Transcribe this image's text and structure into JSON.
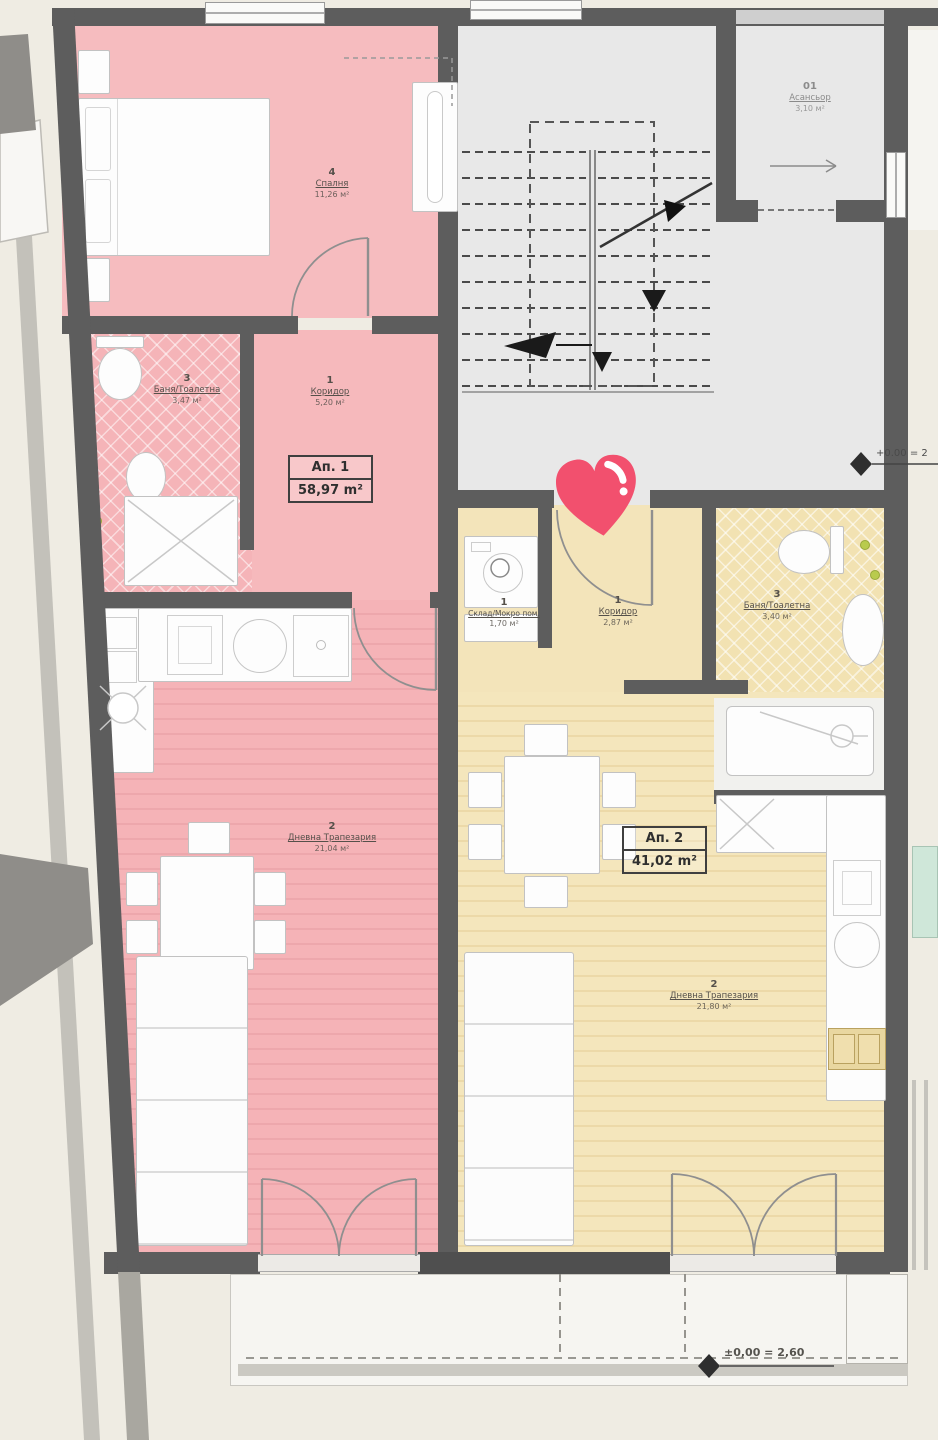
{
  "apartment1": {
    "badge": {
      "title": "Ап. 1",
      "area": "58,97 m²"
    },
    "rooms": {
      "bedroom": {
        "num": "4",
        "name": "Спалня",
        "area": "11,26 м²"
      },
      "bath": {
        "num": "3",
        "name": "Баня/Тоалетна",
        "area": "3,47 м²"
      },
      "corridor": {
        "num": "1",
        "name": "Коридор",
        "area": "5,20 м²"
      },
      "living": {
        "num": "2",
        "name": "Дневна Трапезария",
        "area": "21,04 м²"
      }
    }
  },
  "apartment2": {
    "badge": {
      "title": "Ап. 2",
      "area": "41,02 m²"
    },
    "rooms": {
      "storage": {
        "num": "1",
        "name": "Склад/Мокро пом.",
        "area": "1,70 м²"
      },
      "corridor": {
        "num": "1",
        "name": "Коридор",
        "area": "2,87 м²"
      },
      "bath": {
        "num": "3",
        "name": "Баня/Тоалетна",
        "area": "3,40 м²"
      },
      "living": {
        "num": "2",
        "name": "Дневна Трапезария",
        "area": "21,80 м²"
      }
    }
  },
  "common": {
    "elevator": {
      "num": "01",
      "name": "Асансьор",
      "area": "3,10 м²"
    },
    "elevation_right": "+0.00 = 2",
    "elevation_bottom": "±0,00 = 2,60"
  },
  "colors": {
    "apartment1_fill": "#f5b6ba",
    "apartment2_fill": "#f3e4ba",
    "heart": "#f2506e",
    "wall": "#5d5d5d",
    "stair_floor": "#e8e8e8"
  }
}
